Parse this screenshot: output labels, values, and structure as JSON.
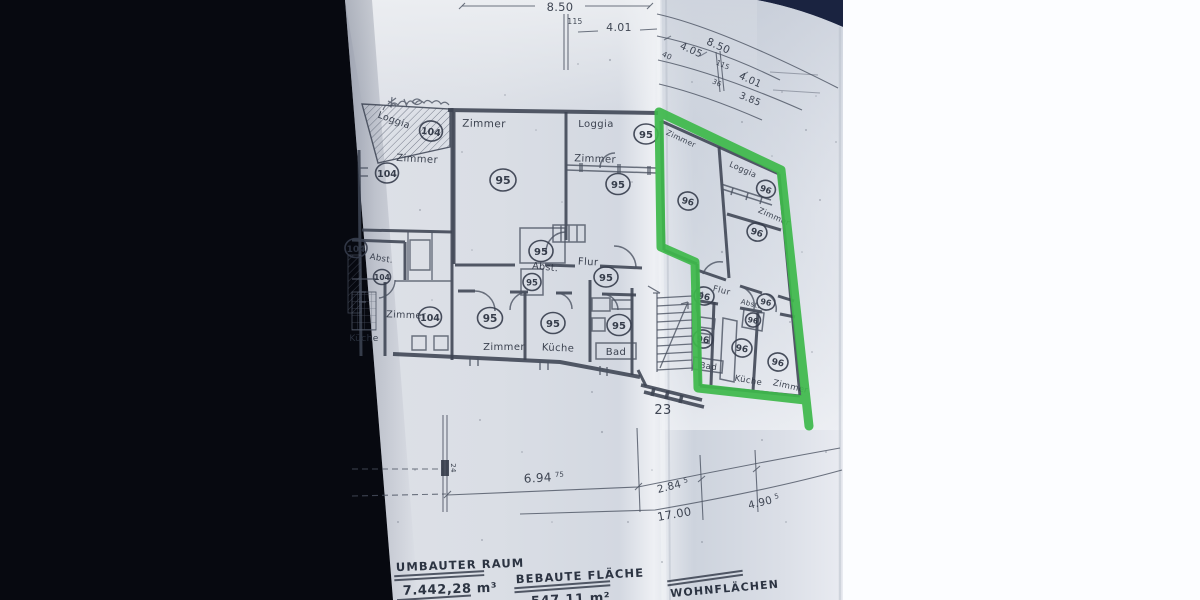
{
  "photo": {
    "background_color": "#070910",
    "fold_shadow_color": "#18203a",
    "paper_color": "#d8dce4",
    "white_sheet_color": "#fcfdff",
    "highlight_color": "#3eb94b",
    "ink_color": "#3c4352"
  },
  "floor_plan": {
    "house_number": "23",
    "units": {
      "unit_104": {
        "loggia": {
          "label": "Loggia",
          "number": "104"
        },
        "zimmer_top": {
          "label": "Zimmer",
          "number": "104"
        },
        "abst": {
          "label": "Abst.",
          "number": "104"
        },
        "abst_number_small": "104",
        "zimmer_bottom": {
          "label": "Zimmer",
          "number": "104"
        },
        "kueche": {
          "label": "Küche"
        }
      },
      "unit_95": {
        "zimmer_big": {
          "label": "Zimmer",
          "number": "95"
        },
        "loggia": {
          "label": "Loggia",
          "number": "95"
        },
        "zimmer_right": {
          "label": "Zimmer",
          "number": "95"
        },
        "abst": {
          "label": "Abst.",
          "number": "95"
        },
        "abst_closet_number": "95",
        "flur": {
          "label": "Flur",
          "number": "95"
        },
        "zimmer_bottom": {
          "label": "Zimmer",
          "number": "95"
        },
        "kueche": {
          "label": "Küche",
          "number": "95"
        },
        "bad": {
          "label": "Bad",
          "number": "95"
        }
      },
      "unit_96": {
        "highlighted": true,
        "zimmer_left": {
          "label": "Zimmer",
          "number": "96"
        },
        "loggia": {
          "label": "Loggia",
          "number": "96"
        },
        "zimmer_right": {
          "label": "Zimmer",
          "number": "96"
        },
        "flur": {
          "label": "Flur",
          "number": "96"
        },
        "abst": {
          "label": "Abst.",
          "number": "96"
        },
        "abst_closet_number": "96",
        "bad": {
          "label": "Bad",
          "number": "96"
        },
        "kueche": {
          "label": "Küche",
          "number": "96"
        },
        "zimmer_bottom": {
          "label": "Zimmer",
          "number": "96"
        }
      }
    },
    "dimensions": {
      "top": {
        "d1": "8.50",
        "d1_tick": "115",
        "d2": "4.01"
      },
      "top_folded": {
        "f_tick_a": "40",
        "f1": "4.05",
        "f2": "8.50",
        "f2_tick": "115",
        "f3_tick": "36",
        "f4": "4.01",
        "f5": "3.85"
      },
      "bottom": {
        "b1": "6.94",
        "b1_sup": "75",
        "b2": "2.84",
        "b2_sup": "5",
        "b3": "17.00",
        "b4": "4.90",
        "b4_sup": "5",
        "tick": "24"
      }
    },
    "summary": {
      "umbauter_raum_label": "UMBAUTER RAUM",
      "umbauter_raum_value": "7.442,28 m³",
      "bebaute_flaeche_label": "BEBAUTE FLÄCHE",
      "bebaute_flaeche_value": "547,11 m²",
      "wohnflaechen_label": "WOHNFLÄCHEN"
    }
  }
}
